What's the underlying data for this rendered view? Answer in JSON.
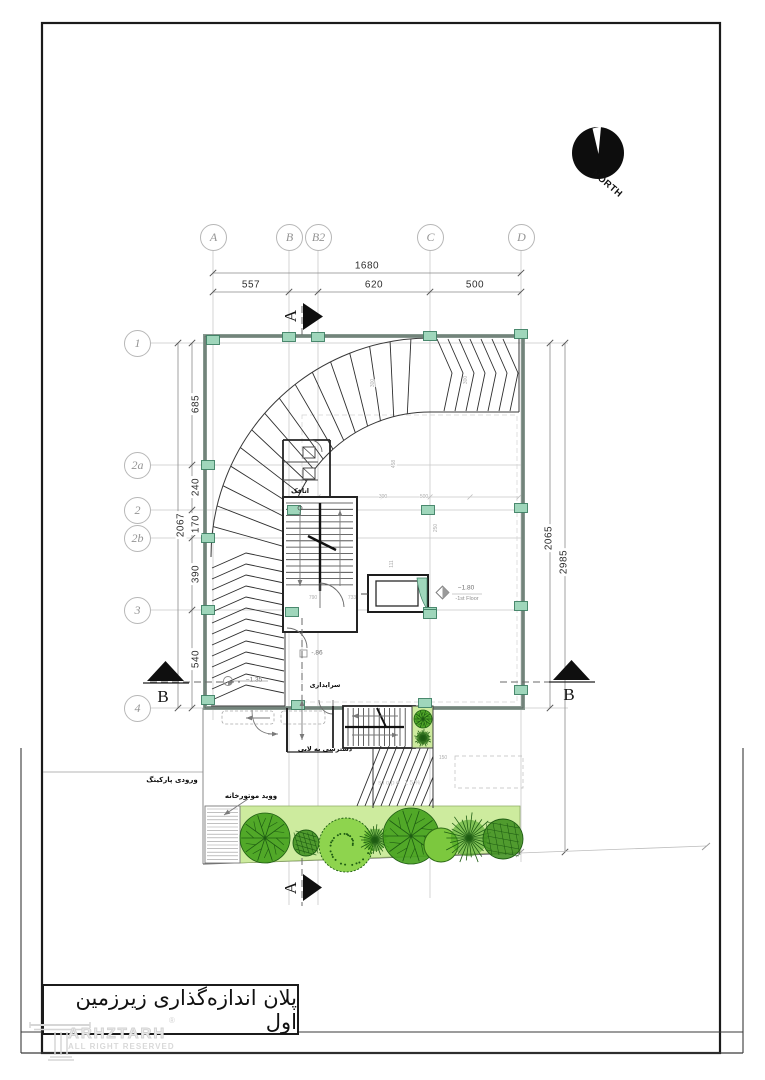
{
  "drawing": {
    "title": "پلان اندازه‌گذاری زیرزمین اول",
    "north_label": "NORTH",
    "watermark": {
      "brand": "ARHZTARH",
      "rights": "ALL RIGHT RESERVED",
      "registered": "®"
    },
    "grid_columns": [
      {
        "label": "A",
        "x": 213
      },
      {
        "label": "B",
        "x": 289
      },
      {
        "label": "B2",
        "x": 318
      },
      {
        "label": "C",
        "x": 430
      },
      {
        "label": "D",
        "x": 521
      }
    ],
    "grid_rows": [
      {
        "label": "1",
        "y": 343
      },
      {
        "label": "2a",
        "y": 465
      },
      {
        "label": "2",
        "y": 510
      },
      {
        "label": "2b",
        "y": 538
      },
      {
        "label": "3",
        "y": 610
      },
      {
        "label": "4",
        "y": 708
      }
    ],
    "dim_labels": [
      {
        "text": "1680",
        "x": 367,
        "y": 266,
        "rot": 0
      },
      {
        "text": "557",
        "x": 251,
        "y": 285,
        "rot": 0
      },
      {
        "text": "620",
        "x": 374,
        "y": 285,
        "rot": 0
      },
      {
        "text": "500",
        "x": 475,
        "y": 285,
        "rot": 0
      },
      {
        "text": "685",
        "x": 196,
        "y": 404,
        "rot": -90
      },
      {
        "text": "240",
        "x": 196,
        "y": 487,
        "rot": -90
      },
      {
        "text": "170",
        "x": 196,
        "y": 524,
        "rot": -90
      },
      {
        "text": "390",
        "x": 196,
        "y": 574,
        "rot": -90
      },
      {
        "text": "540",
        "x": 196,
        "y": 659,
        "rot": -90
      },
      {
        "text": "2067",
        "x": 181,
        "y": 525,
        "rot": -90
      },
      {
        "text": "2065",
        "x": 549,
        "y": 538,
        "rot": -90
      },
      {
        "text": "2985",
        "x": 564,
        "y": 562,
        "rot": -90
      }
    ],
    "section_letters": [
      {
        "label": "A",
        "x": 291,
        "y": 316,
        "rot": -90
      },
      {
        "label": "A",
        "x": 291,
        "y": 888,
        "rot": -90
      },
      {
        "label": "B",
        "x": 163,
        "y": 697,
        "rot": 0
      },
      {
        "label": "B",
        "x": 569,
        "y": 695,
        "rot": 0
      }
    ],
    "level_markers": [
      {
        "text": "−1.80",
        "sub": "-1st Floor",
        "x": 466,
        "y": 588,
        "subx": 467,
        "suby": 599
      },
      {
        "text": "−1.35",
        "x": 254,
        "y": 680
      },
      {
        "text": "-.86",
        "x": 317,
        "y": 653
      }
    ],
    "room_labels": [
      {
        "text": "اتاقک",
        "x": 300,
        "y": 491
      },
      {
        "text": "سرایداری",
        "x": 325,
        "y": 685
      },
      {
        "text": "دسترسی به لابی",
        "x": 325,
        "y": 749
      }
    ],
    "site_labels": [
      {
        "text": "ورودی پارکینگ",
        "x": 172,
        "y": 780
      },
      {
        "text": "ووید موتورخانه",
        "x": 251,
        "y": 796
      }
    ],
    "slope_label": {
      "text": "slope 15%",
      "x": 400,
      "y": 783
    },
    "tiny_dims": [
      {
        "text": "300",
        "x": 383,
        "y": 497,
        "rot": 0
      },
      {
        "text": "500",
        "x": 424,
        "y": 497,
        "rot": 0
      },
      {
        "text": "790",
        "x": 313,
        "y": 598,
        "rot": 0
      },
      {
        "text": "733",
        "x": 352,
        "y": 598,
        "rot": 0
      },
      {
        "text": "150",
        "x": 443,
        "y": 758,
        "rot": 0
      },
      {
        "text": "300",
        "x": 373,
        "y": 383,
        "rot": -90
      },
      {
        "text": "458",
        "x": 394,
        "y": 464,
        "rot": -90
      },
      {
        "text": "250",
        "x": 436,
        "y": 528,
        "rot": -90
      },
      {
        "text": "111",
        "x": 392,
        "y": 564,
        "rot": -90
      },
      {
        "text": "300",
        "x": 466,
        "y": 380,
        "rot": -90
      }
    ],
    "trees": [
      {
        "x": 265,
        "y": 838,
        "r": 25,
        "style": "fern"
      },
      {
        "x": 306,
        "y": 843,
        "r": 13,
        "style": "scribble"
      },
      {
        "x": 346,
        "y": 845,
        "r": 27,
        "style": "dotted"
      },
      {
        "x": 375,
        "y": 840,
        "r": 16,
        "style": "spiky"
      },
      {
        "x": 411,
        "y": 836,
        "r": 28,
        "style": "fern"
      },
      {
        "x": 441,
        "y": 845,
        "r": 17,
        "style": "smooth"
      },
      {
        "x": 469,
        "y": 838,
        "r": 26,
        "style": "spiky"
      },
      {
        "x": 503,
        "y": 839,
        "r": 20,
        "style": "scribble"
      },
      {
        "x": 423,
        "y": 719,
        "r": 9,
        "style": "fern"
      },
      {
        "x": 423,
        "y": 738,
        "r": 9,
        "style": "spiky"
      }
    ],
    "colors": {
      "column_fill": "#9fd6bb",
      "column_border": "#3c7f63",
      "green_strip": "#cdeb9e",
      "tree_dark": "#1e5c13",
      "tree_mid": "#46a21e",
      "tree_light": "#8ed44e",
      "wall": "#87988f",
      "frame": "#1b1b1b"
    }
  }
}
